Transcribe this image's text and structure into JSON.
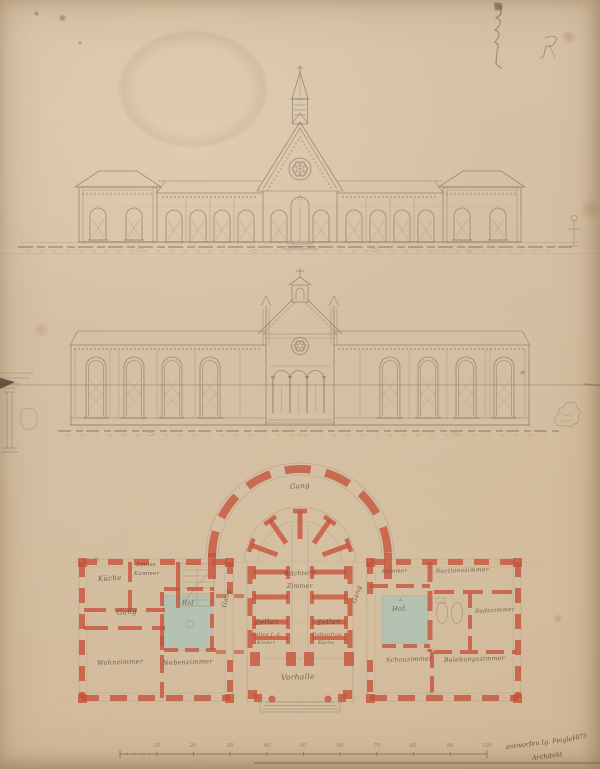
{
  "colors": {
    "paper": "#d5bfa3",
    "pencil": "#79705f",
    "wall_red": "#c5523b",
    "courtyard_green": "#aec3b5",
    "ink": "#564a3a"
  },
  "plan": {
    "room_labels": {
      "apse_corridor": "Gang",
      "warden_room_line1": "Wächter's",
      "warden_room_line2": "Zimmer",
      "cells_left": "Zellen",
      "cells_right": "Zellen",
      "children_cells_line1": "Zellen f. d.",
      "children_cells_line2": "Kinder",
      "attendant_line1": "Todtenfrau",
      "attendant_line2": "Küche",
      "corridor_left": "Gang",
      "corridor_right": "Gang",
      "entrance_hall": "Vorhalle",
      "kitchen": "Küche",
      "pantry_line1": "Speise",
      "pantry_line2": "Kammer",
      "hallway": "Gang",
      "courtyard_left": "Hof",
      "living_room": "Wohnzimmer",
      "side_room": "Nebenzimmer",
      "chamber": "Kammer",
      "dissection_room": "Sectionszimmer",
      "courtyard_right_line1": "z.",
      "courtyard_right_line2": "Hof.",
      "bath_room": "Badezimmer",
      "viewing_room": "Schauzimmer",
      "revival_room": "Belebungszimmer"
    },
    "scale_bar": {
      "ticks": [
        "10",
        "20",
        "30",
        "40",
        "50",
        "60",
        "70",
        "80",
        "90",
        "100"
      ]
    }
  },
  "signature": {
    "year": "1875",
    "line1": "entworfen Ig. Feigler",
    "line2": "Architekt"
  }
}
